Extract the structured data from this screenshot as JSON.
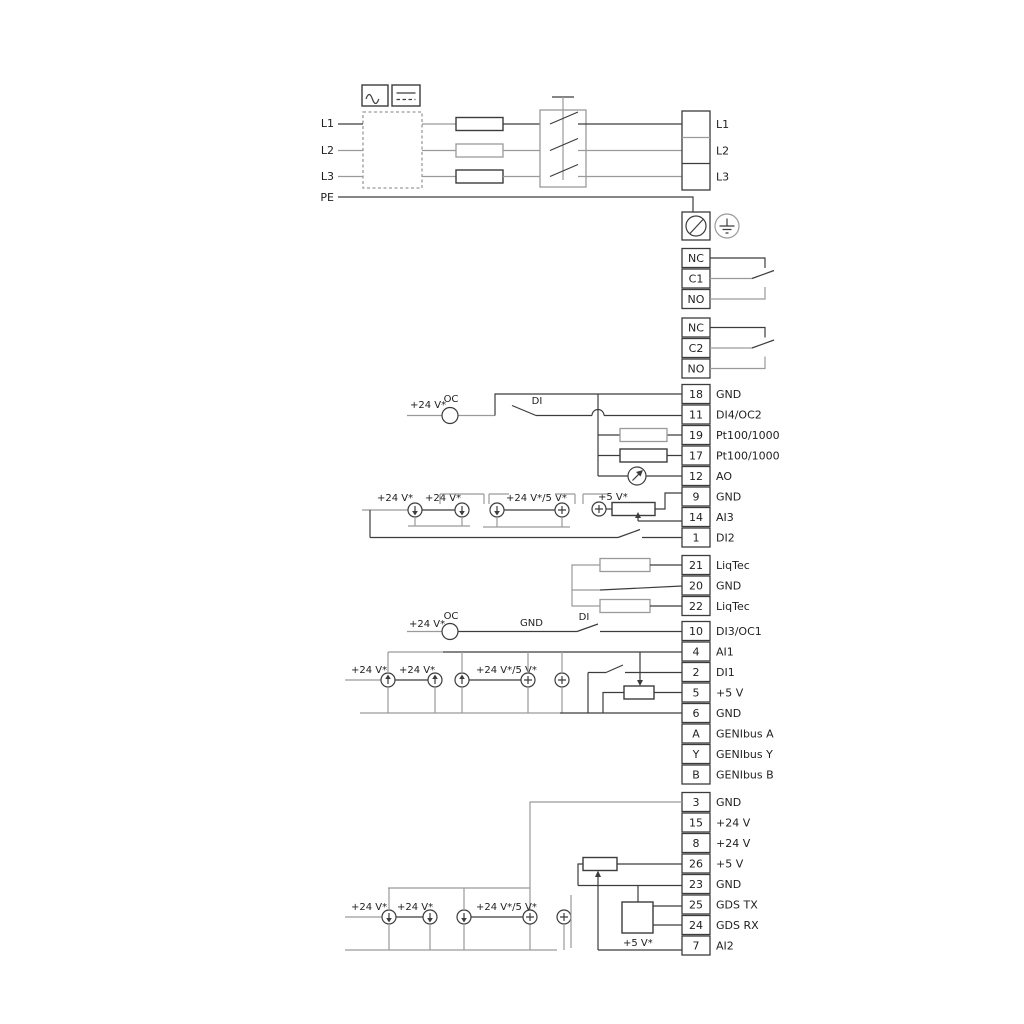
{
  "colors": {
    "wire_dark": "#3c3c3c",
    "wire_gray": "#9a9a9a",
    "text": "#1f1f1f",
    "background": "#ffffff"
  },
  "power": {
    "inputs": [
      "L1",
      "L2",
      "L3",
      "PE"
    ],
    "outputs": [
      "L1",
      "L2",
      "L3"
    ]
  },
  "relays": {
    "r1": [
      "NC",
      "C1",
      "NO"
    ],
    "r2": [
      "NC",
      "C2",
      "NO"
    ]
  },
  "terminal_groups": {
    "io_top": [
      {
        "num": "18",
        "label": "GND"
      },
      {
        "num": "11",
        "label": "DI4/OC2"
      },
      {
        "num": "19",
        "label": "Pt100/1000"
      },
      {
        "num": "17",
        "label": "Pt100/1000"
      },
      {
        "num": "12",
        "label": "AO"
      },
      {
        "num": "9",
        "label": "GND"
      },
      {
        "num": "14",
        "label": "AI3"
      },
      {
        "num": "1",
        "label": "DI2"
      }
    ],
    "liqtec": [
      {
        "num": "21",
        "label": "LiqTec"
      },
      {
        "num": "20",
        "label": "GND"
      },
      {
        "num": "22",
        "label": "LiqTec"
      }
    ],
    "io_mid": [
      {
        "num": "10",
        "label": "DI3/OC1"
      },
      {
        "num": "4",
        "label": "AI1"
      },
      {
        "num": "2",
        "label": "DI1"
      },
      {
        "num": "5",
        "label": "+5 V"
      },
      {
        "num": "6",
        "label": "GND"
      },
      {
        "num": "A",
        "label": "GENIbus A"
      },
      {
        "num": "Y",
        "label": "GENIbus Y"
      },
      {
        "num": "B",
        "label": "GENIbus B"
      }
    ],
    "io_bottom": [
      {
        "num": "3",
        "label": "GND"
      },
      {
        "num": "15",
        "label": "+24 V"
      },
      {
        "num": "8",
        "label": "+24 V"
      },
      {
        "num": "26",
        "label": "+5 V"
      },
      {
        "num": "23",
        "label": "GND"
      },
      {
        "num": "25",
        "label": "GDS TX"
      },
      {
        "num": "24",
        "label": "GDS RX"
      },
      {
        "num": "7",
        "label": "AI2"
      }
    ]
  },
  "annotations": {
    "plus24": "+24 V*",
    "plus24or5": "+24 V*/5 V*",
    "plus5": "+5 V*",
    "oc": "OC",
    "di": "DI",
    "gnd": "GND"
  }
}
